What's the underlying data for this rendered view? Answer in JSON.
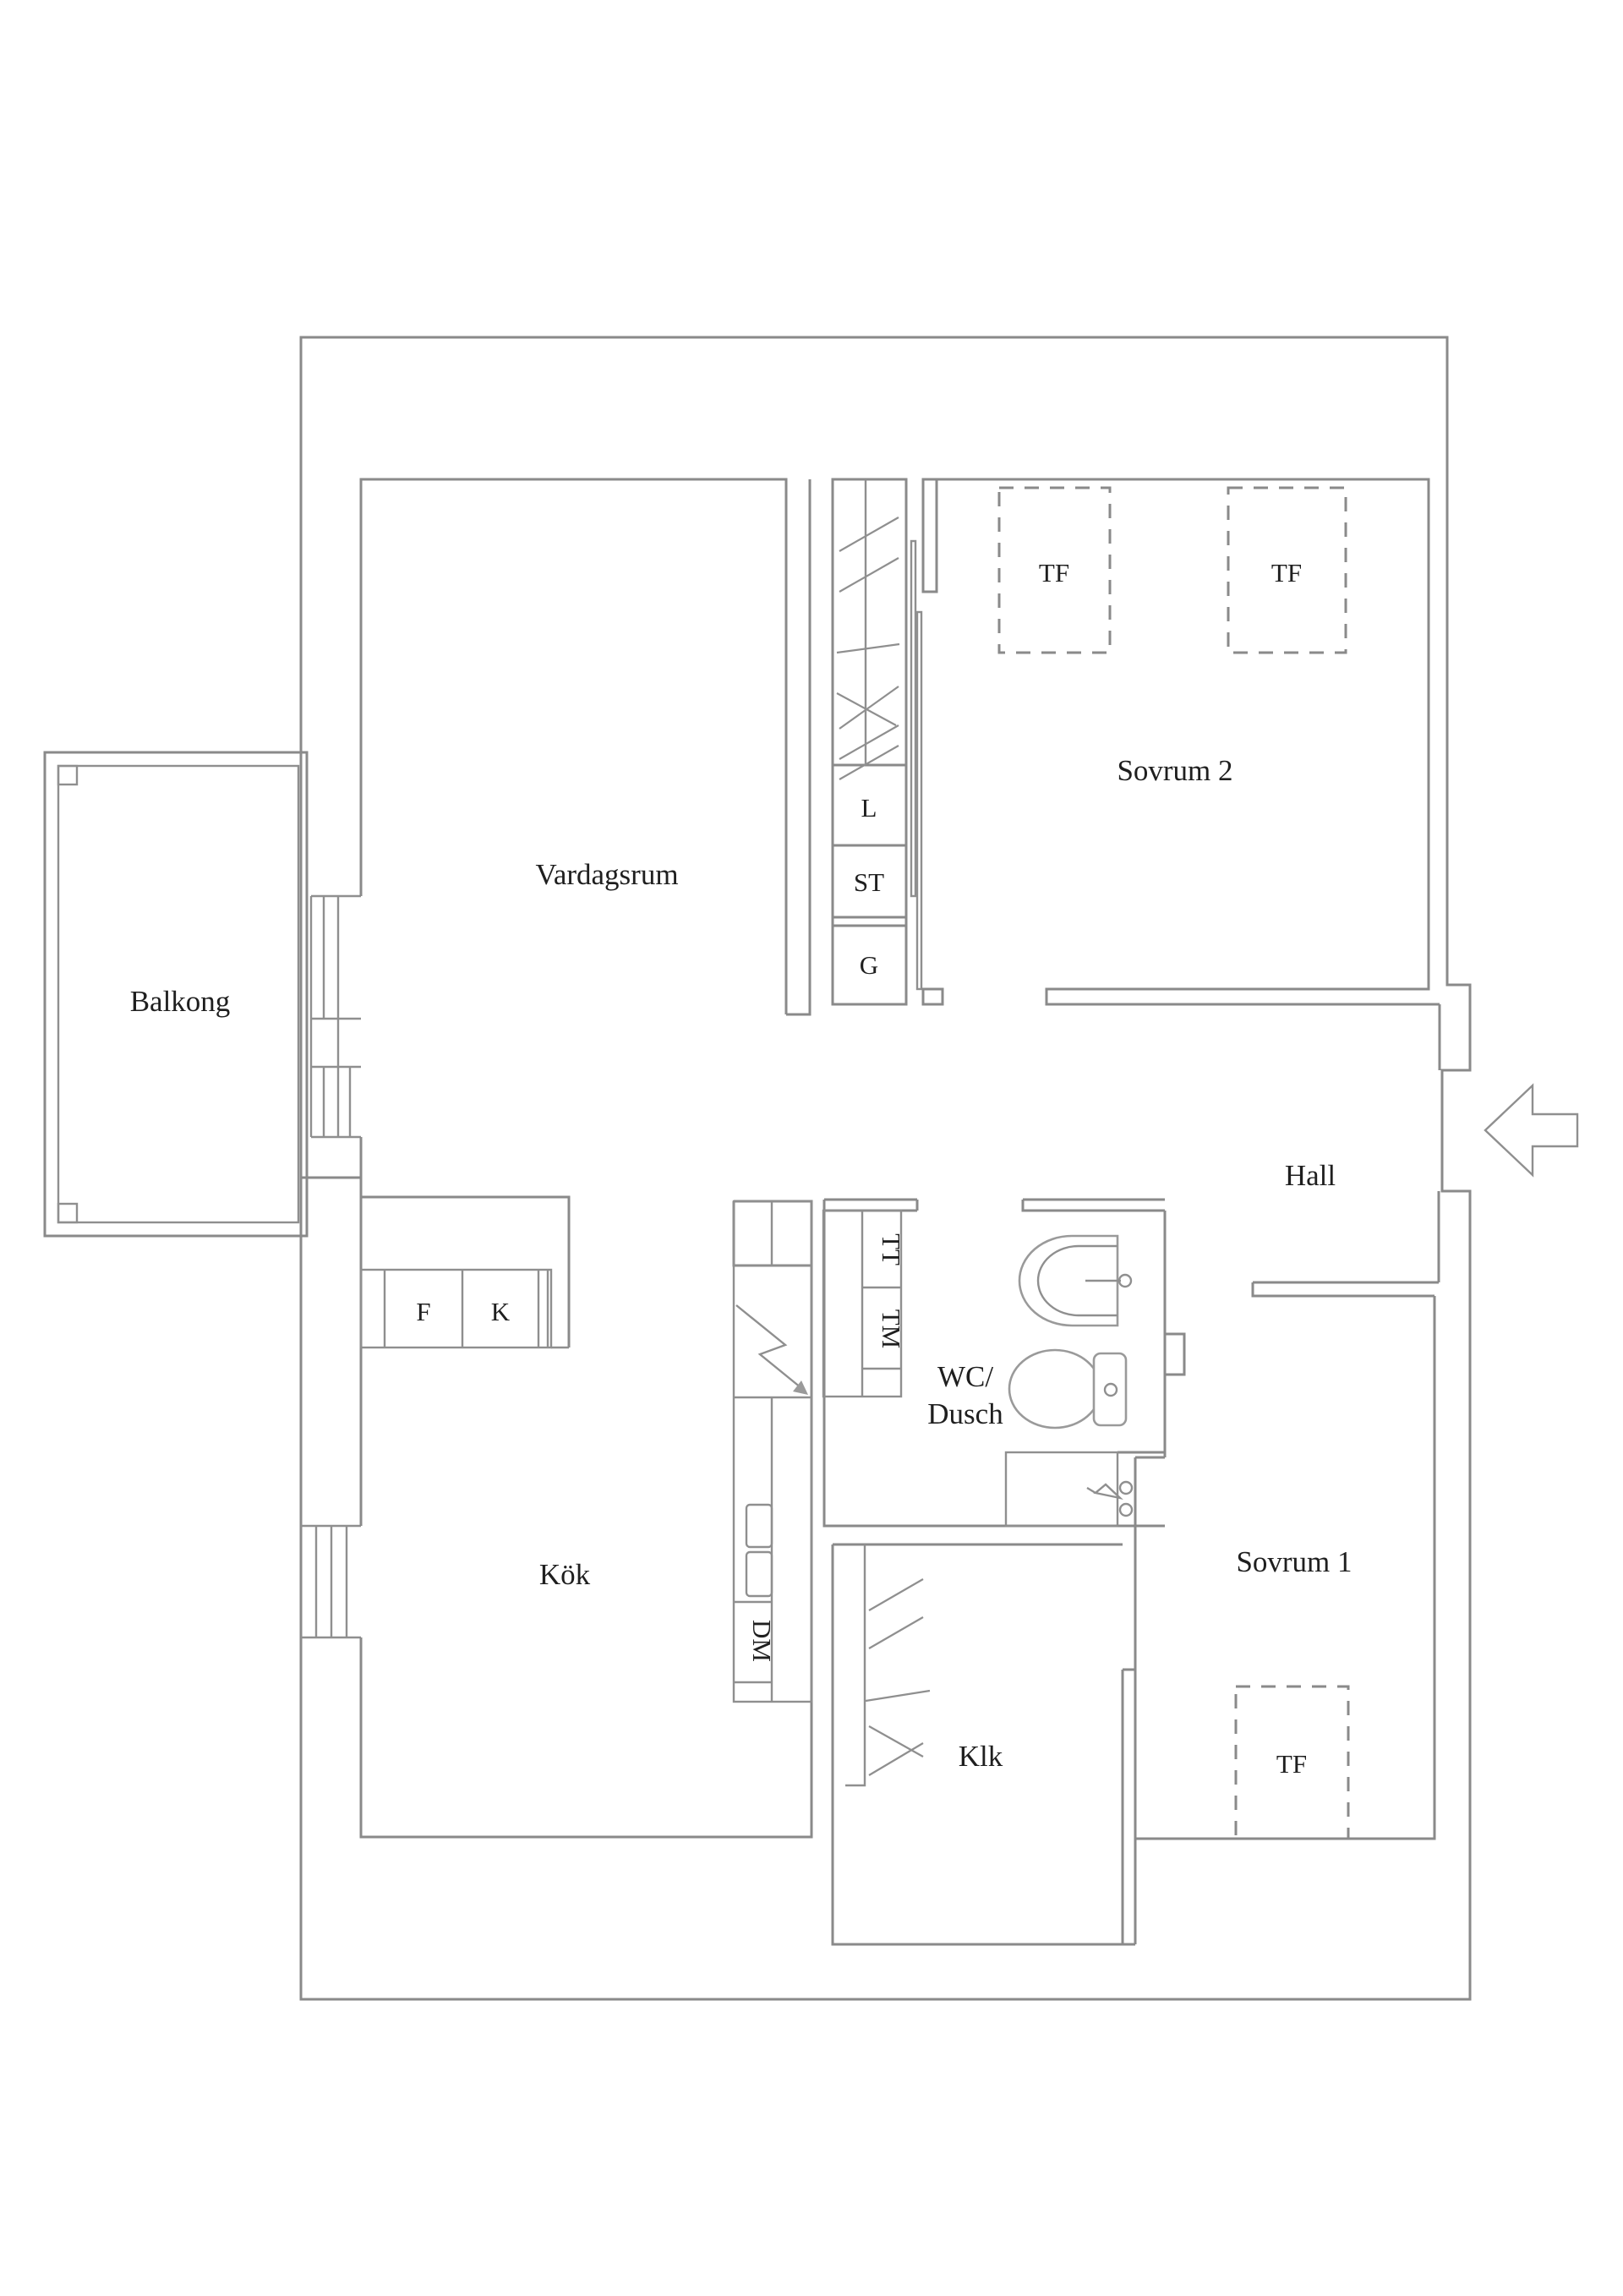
{
  "colors": {
    "background": "#ffffff",
    "wall_line": "#8a8a8a",
    "fixture_line": "#9a9a9a",
    "text": "#1f1f1f"
  },
  "rooms": {
    "balcony": {
      "label": "Balkong"
    },
    "living": {
      "label": "Vardagsrum"
    },
    "bedroom2": {
      "label": "Sovrum 2"
    },
    "hall": {
      "label": "Hall"
    },
    "kitchen": {
      "label": "Kök"
    },
    "bath": {
      "label_line1": "WC/",
      "label_line2": "Dusch"
    },
    "bedroom1": {
      "label": "Sovrum 1"
    },
    "closet": {
      "label": "Klk"
    }
  },
  "fixtures": {
    "tf_bedroom2_left": "TF",
    "tf_bedroom2_right": "TF",
    "tf_bedroom1": "TF",
    "linen_l": "L",
    "st_box": "ST",
    "g_box": "G",
    "f_box": "F",
    "k_box": "K",
    "dm_box": "DM",
    "tt_box": "TT",
    "tm_box": "TM"
  }
}
